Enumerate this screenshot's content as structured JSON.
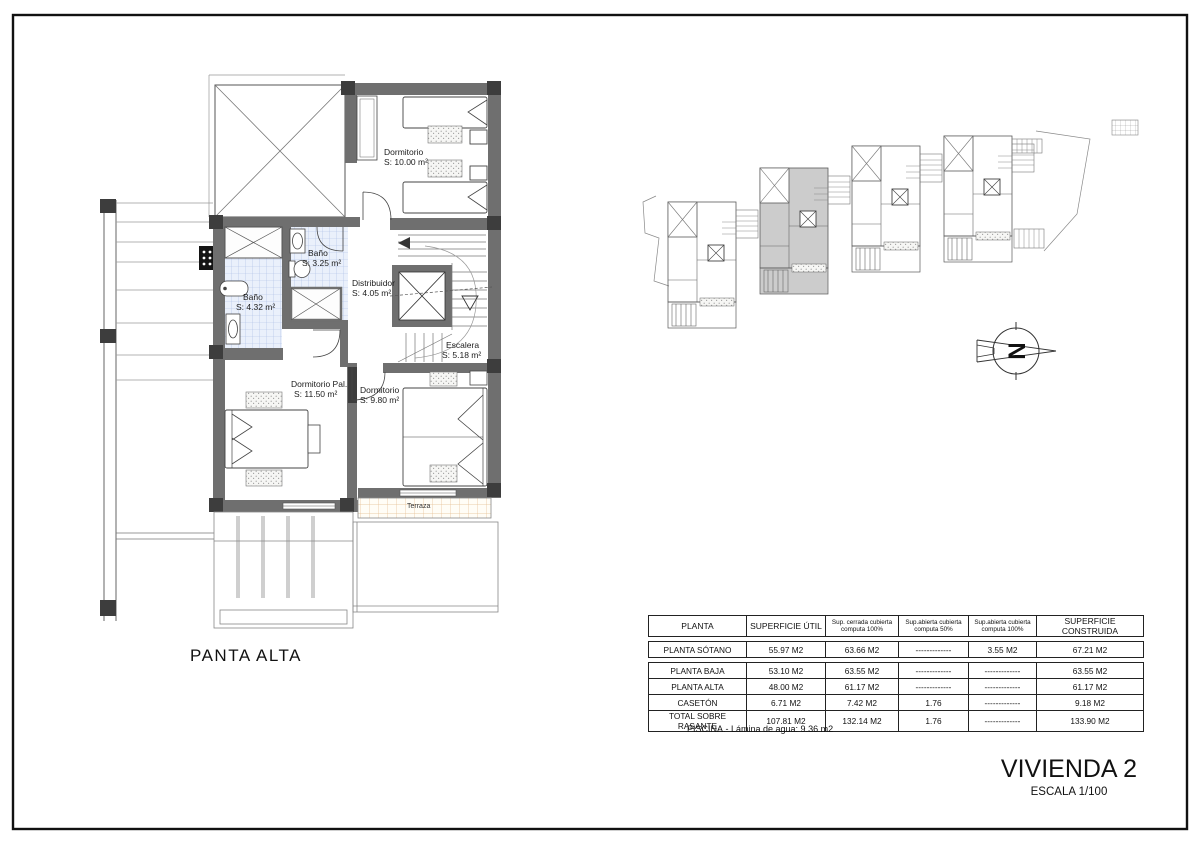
{
  "titleblock": {
    "project": "VIVIENDA 2",
    "scale": "ESCALA 1/100"
  },
  "plan": {
    "caption": "PANTA ALTA",
    "compass_letter": "N",
    "rooms": {
      "dormitorio1": {
        "name": "Dormitorio",
        "area": "S: 10.00 m²"
      },
      "bano1": {
        "name": "Baño",
        "area": "S: 3.25 m²"
      },
      "bano2": {
        "name": "Baño",
        "area": "S: 4.32 m²"
      },
      "distribuidor": {
        "name": "Distribuidor",
        "area": "S: 4.05 m²"
      },
      "escalera": {
        "name": "Escalera",
        "area": "S: 5.18 m²"
      },
      "dormitorio_pal": {
        "name": "Dormitorio Pal.",
        "area": "S: 11.50 m²"
      },
      "dormitorio2": {
        "name": "Dormitorio",
        "area": "S: 9.80 m²"
      },
      "terraza": {
        "name": "Terraza"
      }
    }
  },
  "areas_table": {
    "headers": {
      "planta": "PLANTA",
      "util": "SUPERFICIE ÚTIL",
      "cerrada_l1": "Sup. cerrada cubierta",
      "cerrada_l2": "computa 100%",
      "abierta50_l1": "Sup.abierta cubierta",
      "abierta50_l2": "computa 50%",
      "abierta100_l1": "Sup.abierta cubierta",
      "abierta100_l2": "computa 100%",
      "construida": "SUPERFICIE CONSTRUIDA"
    },
    "rows": [
      [
        "PLANTA SÓTANO",
        "55.97 M2",
        "63.66 M2",
        "-------------",
        "3.55 M2",
        "67.21 M2"
      ],
      [
        "PLANTA BAJA",
        "53.10 M2",
        "63.55 M2",
        "-------------",
        "-------------",
        "63.55 M2"
      ],
      [
        "PLANTA ALTA",
        "48.00 M2",
        "61.17 M2",
        "-------------",
        "-------------",
        "61.17 M2"
      ],
      [
        "CASETÓN",
        "6.71 M2",
        "7.42 M2",
        "1.76",
        "-------------",
        "9.18 M2"
      ],
      [
        "TOTAL SOBRE RASANTE",
        "107.81 M2",
        "132.14 M2",
        "1.76",
        "-------------",
        "133.90 M2"
      ]
    ],
    "note": "PISCINA.- Lámina de agua: 9.36 m2"
  },
  "colors": {
    "wall": "#6f6f6f",
    "corner_block": "#3d3d3d",
    "bath_tile_bg": "#eaf0fb",
    "bath_tile_line": "#a9bce4",
    "terrace_tile_line": "#e4bd8f",
    "highlighted_unit": "#cccccc"
  }
}
